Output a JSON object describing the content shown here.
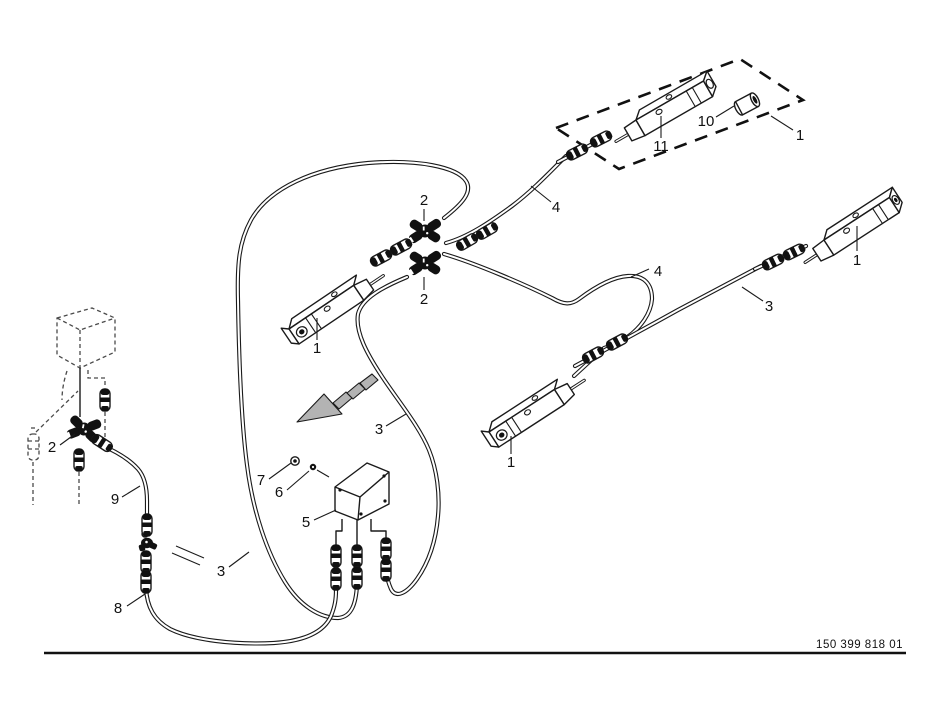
{
  "diagram": {
    "title_hint": "work-light cable harness parts diagram",
    "background": "#ffffff",
    "line_color": "#1a1a1a",
    "arrow_fill": "#b3b3b3",
    "doc_number": "150 399 818 01",
    "callouts": [
      {
        "id": "light-bar-on-plate",
        "text": "11"
      },
      {
        "id": "grommet",
        "text": "10"
      },
      {
        "id": "mounting-plate",
        "text": "1"
      },
      {
        "id": "y-connector-top",
        "text": "2"
      },
      {
        "id": "cable-top",
        "text": "4"
      },
      {
        "id": "y-connector-bottom",
        "text": "2"
      },
      {
        "id": "cable-loop",
        "text": "4"
      },
      {
        "id": "cable-right",
        "text": "3"
      },
      {
        "id": "work-light-right",
        "text": "1"
      },
      {
        "id": "work-light-left",
        "text": "1"
      },
      {
        "id": "work-light-middle",
        "text": "1"
      },
      {
        "id": "cable-middle",
        "text": "3"
      },
      {
        "id": "y-connector-left",
        "text": "2"
      },
      {
        "id": "cable-nine",
        "text": "9"
      },
      {
        "id": "screw-seven",
        "text": "7"
      },
      {
        "id": "screw-six",
        "text": "6"
      },
      {
        "id": "junction-box",
        "text": "5"
      },
      {
        "id": "cable-bottom",
        "text": "3"
      },
      {
        "id": "cable-eight",
        "text": "8"
      }
    ]
  }
}
